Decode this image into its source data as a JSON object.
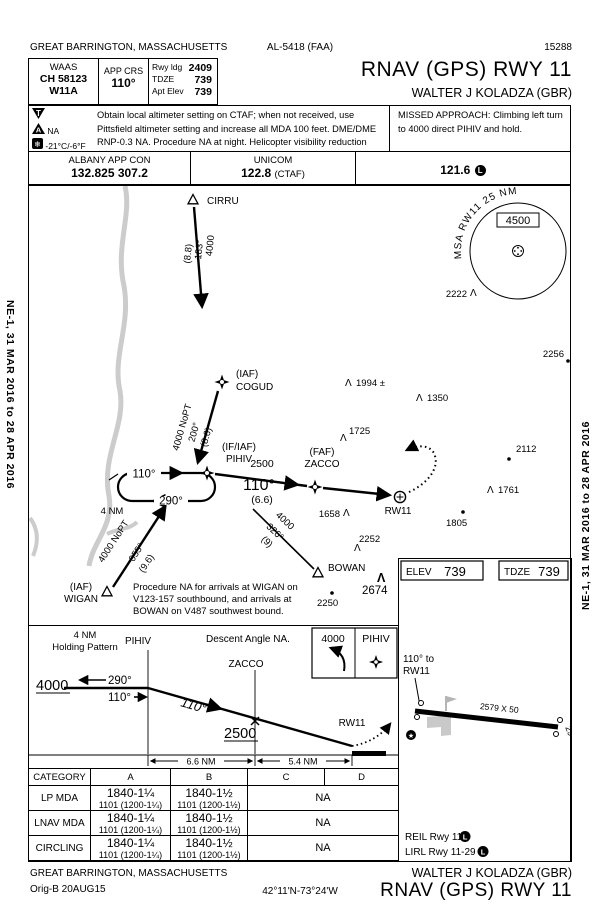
{
  "binding": {
    "strip": "NE-1, 31 MAR 2016 to 28 APR 2016"
  },
  "header": {
    "city": "GREAT BARRINGTON, MASSACHUSETTS",
    "al_ref": "AL-5418 (FAA)",
    "serial": "15288",
    "waas_label": "WAAS",
    "waas_ch": "CH 58123",
    "waas_ident": "W11A",
    "app_crs_label": "APP CRS",
    "app_crs_value": "110°",
    "rwy_ldg_label": "Rwy ldg",
    "rwy_ldg_value": "2409",
    "tdze_label": "TDZE",
    "tdze_value": "739",
    "apt_elev_label": "Apt Elev",
    "apt_elev_value": "739",
    "procedure_title": "RNAV (GPS) RWY 11",
    "airport_name": "WALTER J KOLADZA (GBR)"
  },
  "notes": {
    "takeoff_glyph": "T",
    "alternate_glyph": "A",
    "alternate_na": "NA",
    "snowflake_glyph": "❄",
    "cold_temp": "-21°C/-6°F",
    "body": "Obtain local altimeter setting on CTAF; when not received, use Pittsfield altimeter setting and increase all MDA 100 feet. DME/DME RNP-0.3 NA. Procedure NA at night. Helicopter visibility reduction below 1 SM NA.",
    "missed_title": "MISSED APPROACH:",
    "missed_body": "Climbing left turn to 4000 direct PIHIV and hold."
  },
  "freqs": {
    "app_name": "ALBANY APP CON",
    "app_value": "132.825 307.2",
    "unicom_name": "UNICOM",
    "unicom_value": "122.8",
    "unicom_suffix": "(CTAF)",
    "aux_value": "121.6",
    "part_time_glyph": "L"
  },
  "plan": {
    "cirru": "CIRRU",
    "cirru_track": {
      "alt": "4000",
      "crs": "183°",
      "dist": "(8.8)"
    },
    "cogud_type": "(IAF)",
    "cogud": "COGUD",
    "cogud_track": {
      "alt": "4000 NoPT",
      "crs": "200°",
      "dist": "(8.6)"
    },
    "pihiv_type": "(IF/IAF)",
    "pihiv": "PIHIV",
    "hold": {
      "inbound": "110°",
      "outbound": "290°",
      "leg": "4 NM"
    },
    "pz_track": {
      "alt": "2500",
      "crs": "110°",
      "dist": "(6.6)"
    },
    "zacco_type": "(FAF)",
    "zacco": "ZACCO",
    "rw11": "RW11",
    "wigan_type": "(IAF)",
    "wigan": "WIGAN",
    "wigan_track": {
      "alt": "4000 NoPT",
      "crs": "055°",
      "dist": "(9.6)"
    },
    "bowan": "BOWAN",
    "bowan_track": {
      "alt": "4000",
      "crs": "326°",
      "dist": "(9)"
    },
    "msa": {
      "arc_label": "MSA RW11 25 NM",
      "altitude": "4500"
    },
    "obstacles": {
      "o2222": "2222",
      "o2256": "2256",
      "o1994": "1994 ±",
      "o1350": "1350",
      "o1725": "1725",
      "o2112": "2112",
      "o1761": "1761",
      "o1658": "1658",
      "o1805": "1805",
      "o2252": "2252",
      "o2250": "2250",
      "o2674": "2674"
    },
    "note_l1": "Procedure NA for arrivals at WIGAN on",
    "note_l2": "V123-157 southbound, and arrivals at",
    "note_l3": "BOWAN on V487 southwest bound."
  },
  "profile": {
    "hold_l1": "4 NM",
    "hold_l2": "Holding Pattern",
    "pihiv": "PIHIV",
    "zacco": "ZACCO",
    "rw11": "RW11",
    "descent_note": "Descent Angle NA.",
    "ma_alt": "4000",
    "ma_fix": "PIHIV",
    "alt_4000": "4000",
    "out_290": "290°",
    "in_110": "110°",
    "seg_110": "110°",
    "alt_2500": "2500",
    "d1": "6.6 NM",
    "d2": "5.4 NM"
  },
  "minimums": {
    "category_label": "CATEGORY",
    "cat_a": "A",
    "cat_b": "B",
    "cat_c": "C",
    "cat_d": "D",
    "rows": [
      {
        "label": "LP MDA",
        "a1": "1840-1¼",
        "a2": "1101 (1200-1¼)",
        "b1": "1840-1½",
        "b2": "1101 (1200-1½)",
        "cd": "NA"
      },
      {
        "label": "LNAV MDA",
        "a1": "1840-1¼",
        "a2": "1101 (1200-1¼)",
        "b1": "1840-1½",
        "b2": "1101 (1200-1½)",
        "cd": "NA"
      },
      {
        "label": "CIRCLING",
        "a1": "1840-1¼",
        "a2": "1101 (1200-1¼)",
        "b1": "1840-1½",
        "b2": "1101 (1200-1½)",
        "cd": "NA"
      }
    ]
  },
  "sketch": {
    "elev_label": "ELEV",
    "elev_value": "739",
    "tdze_label": "TDZE",
    "tdze_value": "739",
    "course_l1": "110° to",
    "course_l2": "RW11",
    "rwy_dims": "2579 X 50",
    "rwy_end": "29",
    "beacon_glyph": "★",
    "light1": "REIL Rwy 11",
    "light2": "LIRL Rwy 11-29",
    "part_time_glyph": "L"
  },
  "footer": {
    "city": "GREAT BARRINGTON, MASSACHUSETTS",
    "orig": "Orig-B  20AUG15",
    "coords": "42°11'N-73°24'W",
    "airport_name": "WALTER J KOLADZA (GBR)",
    "procedure_title": "RNAV (GPS) RWY 11"
  }
}
